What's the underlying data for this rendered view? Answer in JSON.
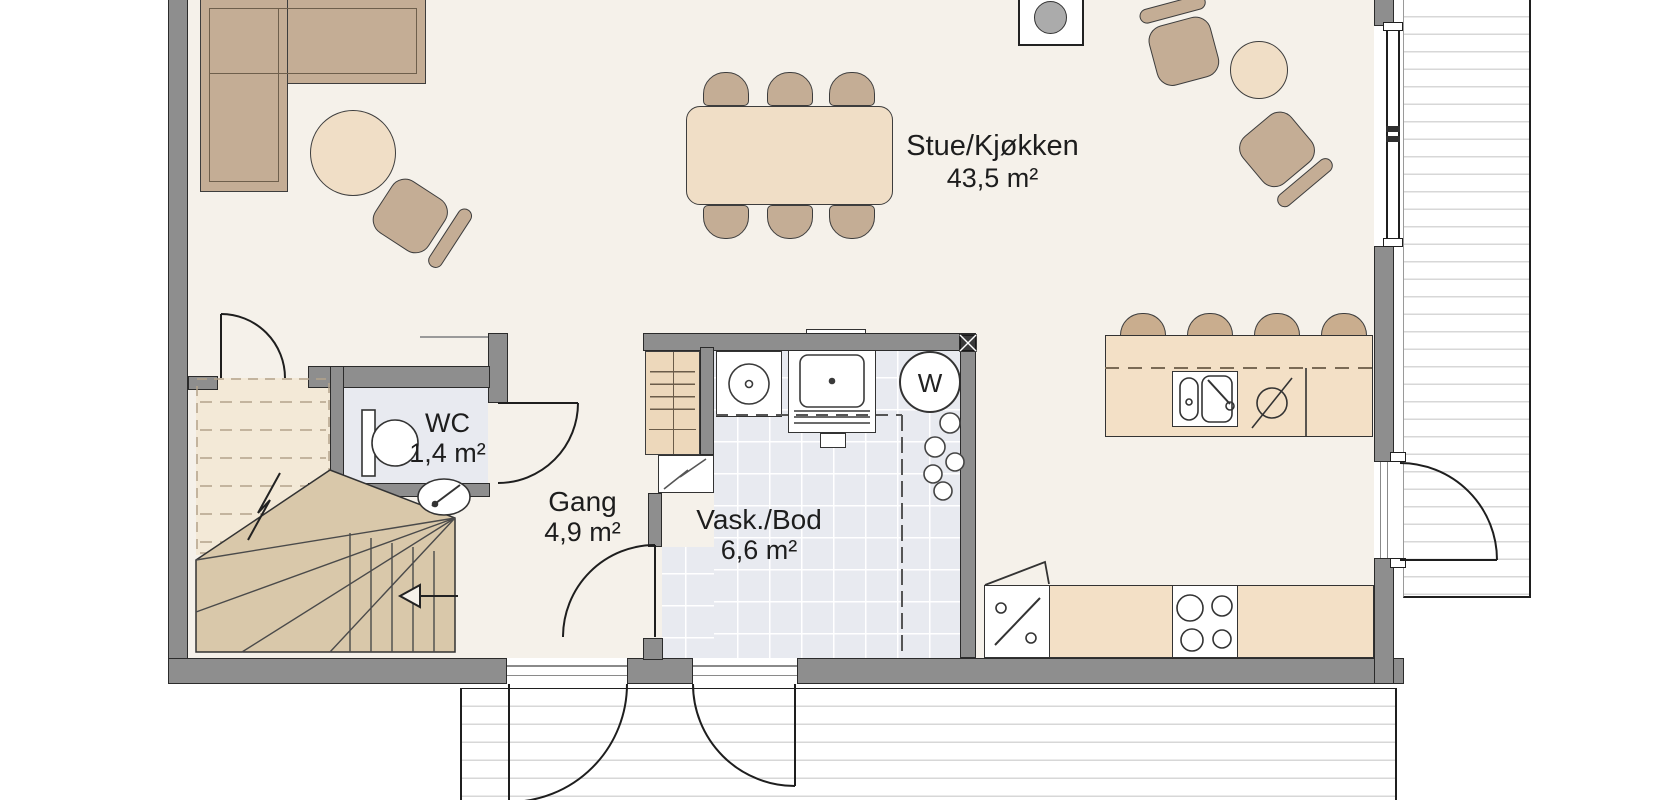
{
  "plan_title": "floor-plan-first-floor",
  "rooms": [
    {
      "id": "stue-kjokken",
      "name": "Stue/Kjøkken",
      "area": "43,5 m²"
    },
    {
      "id": "wc",
      "name": "WC",
      "area": "1,4 m²"
    },
    {
      "id": "gang",
      "name": "Gang",
      "area": "4,9 m²"
    },
    {
      "id": "vask-bod",
      "name": "Vask./Bod",
      "area": "6,6 m²"
    }
  ],
  "appliances": {
    "washer_label": "W"
  },
  "colors": {
    "wall": "#8e8e8e",
    "floor": "#f5f1ea",
    "wet_floor": "#e8eaf0",
    "furniture": "#c4ad95",
    "table": "#f0dec6",
    "stair": "#d9c8aa",
    "counter": "#f3e0c6",
    "deck_line": "#d7d7d7"
  }
}
